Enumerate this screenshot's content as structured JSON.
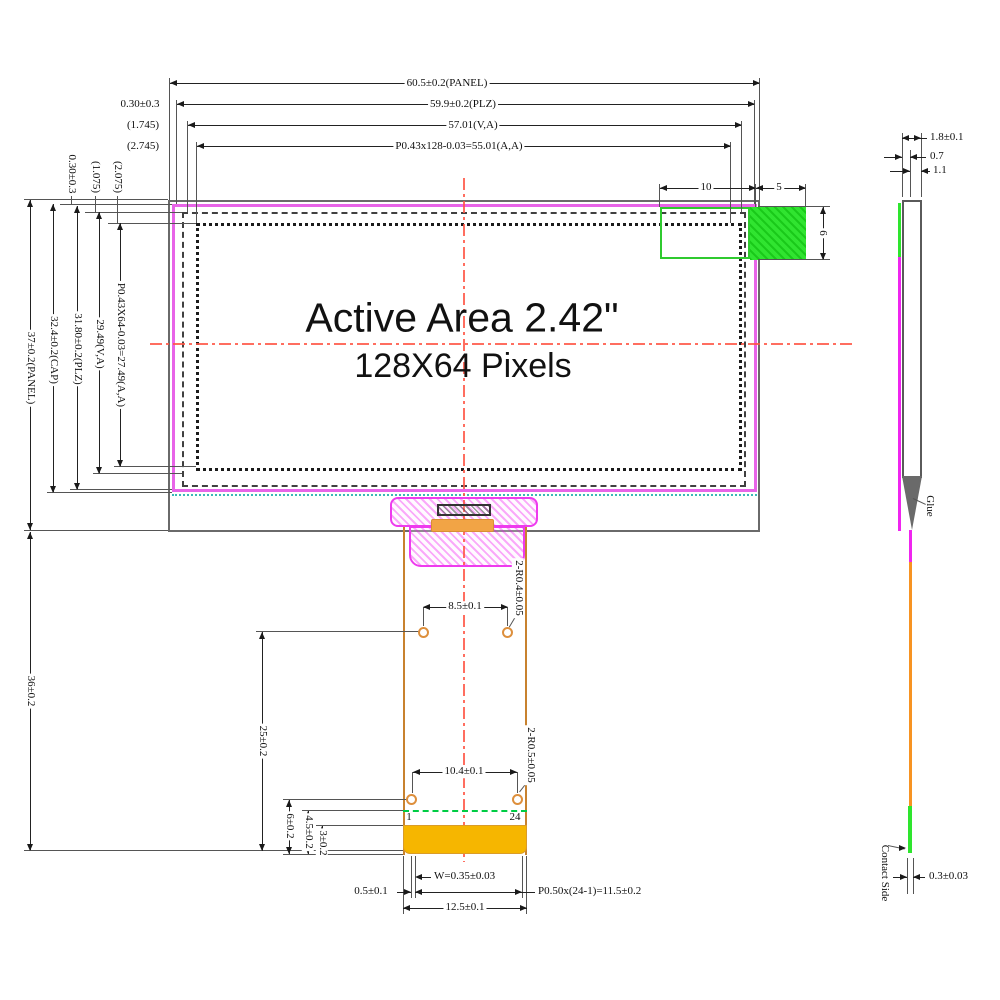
{
  "front": {
    "active_area_line1": "Active Area 2.42\"",
    "active_area_line2": "128X64 Pixels",
    "dims": {
      "panel_w": "60.5±0.2(PANEL)",
      "plz_w": "59.9±0.2(PLZ)",
      "va_w": "57.01(V,A)",
      "aa_w": "P0.43x128-0.03=55.01(A,A)",
      "plz_off_h": "0.30±0.3",
      "va_off_h": "(1.745)",
      "aa_off_h": "(2.745)",
      "plz_off_v": "0.30±0.3",
      "va_off_v": "(1.075)",
      "aa_off_v": "(2.075)",
      "panel_h": "37±0.2(PANEL)",
      "cap_h": "32.4±0.2(CAP)",
      "plz_h": "31.80±0.2(PLZ)",
      "va_h": "29.49(V,A)",
      "aa_h": "P0.43X64-0.03=27.49(A,A)",
      "module_len": "36±0.2",
      "tape_inset": "10",
      "tape_w": "5",
      "tape_h": "6"
    }
  },
  "fpc": {
    "dims": {
      "top_holes_pitch": "8.5±0.1",
      "top_holes_radius": "2-R0.4±0.05",
      "holes_spacing": "25±0.2",
      "bottom_holes_pitch": "10.4±0.1",
      "bottom_holes_radius": "2-R0.5±0.05",
      "hole_to_edge": "6±0.2",
      "pin_row_to_edge": "4.5±0.2",
      "contact_len": "3±0.2",
      "finger_width": "W=0.35±0.03",
      "edge_margin": "0.5±0.1",
      "pitch_total": "P0.50x(24-1)=11.5±0.2",
      "fpc_width": "12.5±0.1"
    },
    "pin_first": "1",
    "pin_last": "24"
  },
  "side": {
    "dims": {
      "thickness_total": "1.8±0.1",
      "thickness_panel": "0.7",
      "thickness_glass": "1.1",
      "fpc_thickness": "0.3±0.03"
    },
    "labels": {
      "glue": "Glue",
      "contact_side": "Contact Side"
    }
  },
  "colors": {
    "polarizer_magenta": "#ee55ee",
    "tape_green": "#2ee52e",
    "connector_magenta": "#ee3bee",
    "fpc_outline_orange": "#c8822f",
    "contact_gold": "#f6b600",
    "centerline_red": "#ff4433",
    "pin_row_green": "#00cc44"
  }
}
